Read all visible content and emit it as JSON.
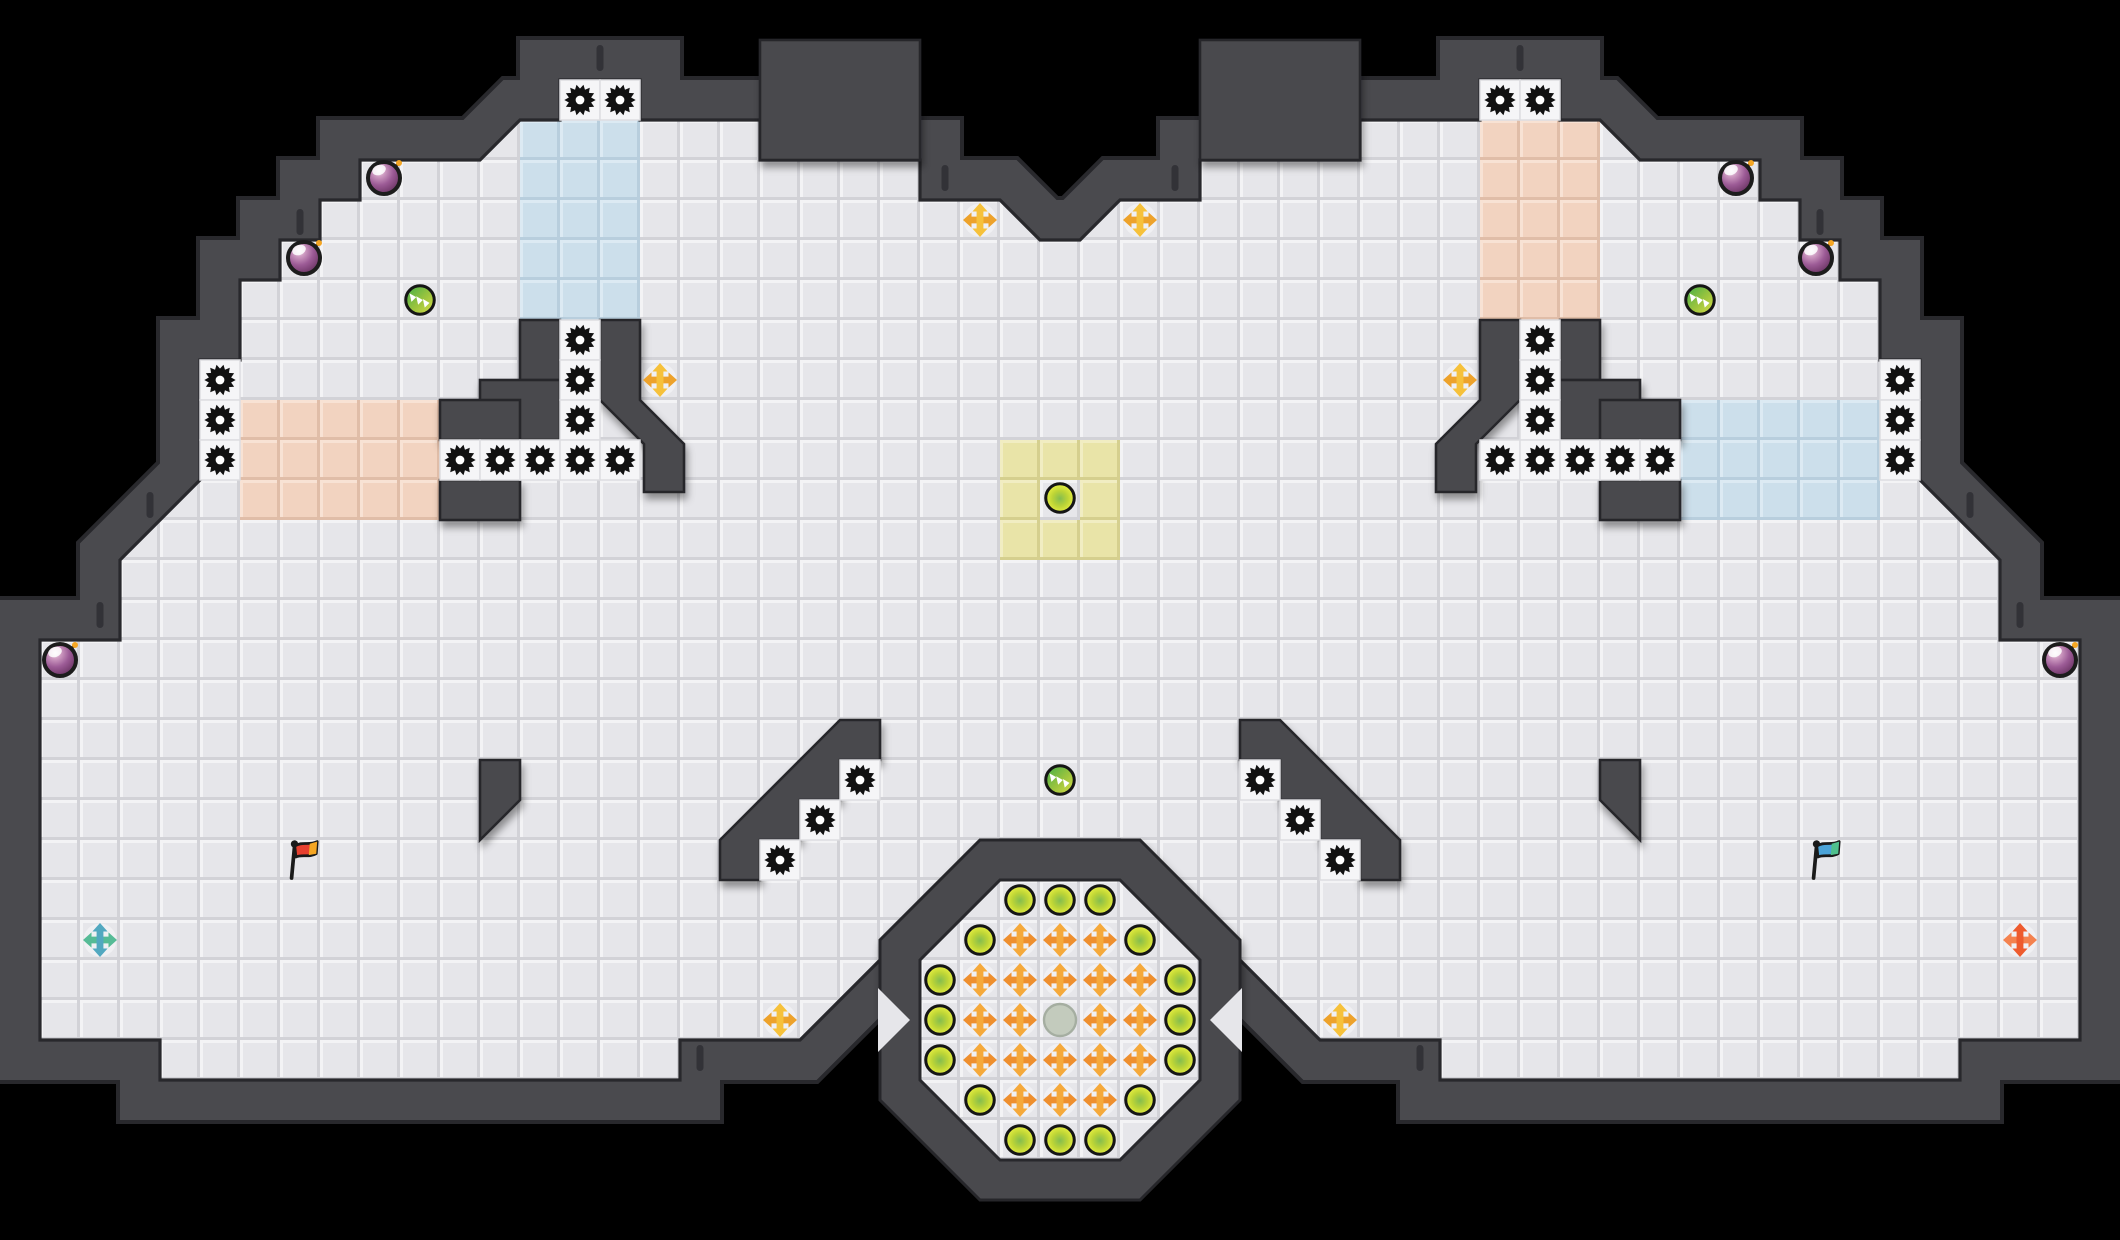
{
  "scene": {
    "width": 2120,
    "height": 1240,
    "background": "#000000",
    "tile_size": 40
  },
  "palette": {
    "floor": "#e6e6ea",
    "floor_hi": "#f3f3f5",
    "floor_lo": "#d2d2d7",
    "wall": "#4a4a4e",
    "wall_edge": "#28282c",
    "gear_cell": "#f5f5f7",
    "team_blue": "#ccdfeb",
    "team_pink": "#f2d3c0",
    "team_yellow": "#e9e4a8",
    "gear": "#111111",
    "bomb_outline": "#1c1c1c",
    "boost_gold_v": "#f6c13b",
    "boost_gold_h": "#eda22b",
    "boost_orange_v": "#f5a93b",
    "boost_orange_h": "#ee8f2e",
    "boost_teal_v": "#52a8c0",
    "boost_teal_h": "#56bb96",
    "boost_red_v": "#ee5b2e",
    "boost_red_h": "#f4824f",
    "flag_red": "#e8402f",
    "flag_red_tip": "#f5a623",
    "flag_blue": "#4ba3d8",
    "flag_blue_tip": "#4fc08d",
    "gray_pad": "#c3cbbd",
    "gray_pad_edge": "#a5aea1"
  },
  "map": {
    "floor_outline": [
      [
        560,
        80
      ],
      [
        640,
        80
      ],
      [
        640,
        120
      ],
      [
        760,
        120
      ],
      [
        760,
        160
      ],
      [
        920,
        160
      ],
      [
        920,
        200
      ],
      [
        1000,
        200
      ],
      [
        1040,
        240
      ],
      [
        1080,
        240
      ],
      [
        1120,
        200
      ],
      [
        1200,
        200
      ],
      [
        1200,
        160
      ],
      [
        1360,
        160
      ],
      [
        1360,
        120
      ],
      [
        1480,
        120
      ],
      [
        1480,
        80
      ],
      [
        1560,
        80
      ],
      [
        1560,
        120
      ],
      [
        1600,
        120
      ],
      [
        1640,
        160
      ],
      [
        1760,
        160
      ],
      [
        1760,
        200
      ],
      [
        1800,
        200
      ],
      [
        1800,
        240
      ],
      [
        1840,
        240
      ],
      [
        1840,
        280
      ],
      [
        1880,
        280
      ],
      [
        1880,
        360
      ],
      [
        1920,
        360
      ],
      [
        1920,
        480
      ],
      [
        2000,
        560
      ],
      [
        2000,
        640
      ],
      [
        2080,
        640
      ],
      [
        2080,
        1040
      ],
      [
        1960,
        1040
      ],
      [
        1960,
        1080
      ],
      [
        1440,
        1080
      ],
      [
        1440,
        1040
      ],
      [
        1320,
        1040
      ],
      [
        1120,
        840
      ],
      [
        1000,
        840
      ],
      [
        800,
        1040
      ],
      [
        680,
        1040
      ],
      [
        680,
        1080
      ],
      [
        160,
        1080
      ],
      [
        160,
        1040
      ],
      [
        40,
        1040
      ],
      [
        40,
        640
      ],
      [
        120,
        640
      ],
      [
        120,
        560
      ],
      [
        200,
        480
      ],
      [
        200,
        360
      ],
      [
        240,
        360
      ],
      [
        240,
        280
      ],
      [
        280,
        280
      ],
      [
        280,
        240
      ],
      [
        320,
        240
      ],
      [
        320,
        200
      ],
      [
        360,
        200
      ],
      [
        360,
        160
      ],
      [
        480,
        160
      ],
      [
        520,
        120
      ],
      [
        560,
        120
      ]
    ],
    "wall_rects": [
      [
        760,
        40,
        160,
        120
      ],
      [
        1200,
        40,
        160,
        120
      ],
      [
        520,
        320,
        40,
        60
      ],
      [
        480,
        380,
        80,
        60
      ],
      [
        440,
        400,
        80,
        40
      ],
      [
        440,
        480,
        80,
        40
      ],
      [
        1560,
        320,
        40,
        60
      ],
      [
        1560,
        380,
        80,
        60
      ],
      [
        1600,
        400,
        80,
        40
      ],
      [
        1600,
        480,
        80,
        40
      ]
    ],
    "wall_polys": [
      [
        [
          600,
          320
        ],
        [
          640,
          320
        ],
        [
          640,
          400
        ],
        [
          684,
          444
        ],
        [
          684,
          492
        ],
        [
          644,
          492
        ],
        [
          644,
          444
        ],
        [
          600,
          400
        ]
      ],
      [
        [
          1520,
          320
        ],
        [
          1480,
          320
        ],
        [
          1480,
          400
        ],
        [
          1436,
          444
        ],
        [
          1436,
          492
        ],
        [
          1476,
          492
        ],
        [
          1476,
          444
        ],
        [
          1520,
          400
        ]
      ],
      [
        [
          840,
          720
        ],
        [
          880,
          720
        ],
        [
          880,
          760
        ],
        [
          840,
          760
        ],
        [
          840,
          800
        ],
        [
          800,
          800
        ],
        [
          800,
          840
        ],
        [
          760,
          840
        ],
        [
          760,
          880
        ],
        [
          720,
          880
        ],
        [
          720,
          840
        ]
      ],
      [
        [
          1280,
          720
        ],
        [
          1240,
          720
        ],
        [
          1240,
          760
        ],
        [
          1280,
          760
        ],
        [
          1280,
          800
        ],
        [
          1320,
          800
        ],
        [
          1320,
          840
        ],
        [
          1360,
          840
        ],
        [
          1360,
          880
        ],
        [
          1400,
          880
        ],
        [
          1400,
          840
        ]
      ],
      [
        [
          480,
          760
        ],
        [
          520,
          760
        ],
        [
          520,
          800
        ],
        [
          480,
          840
        ]
      ],
      [
        [
          1640,
          760
        ],
        [
          1600,
          760
        ],
        [
          1600,
          800
        ],
        [
          1640,
          840
        ]
      ]
    ],
    "octagon": {
      "outer": [
        [
          980,
          840
        ],
        [
          1140,
          840
        ],
        [
          1240,
          940
        ],
        [
          1240,
          1100
        ],
        [
          1140,
          1200
        ],
        [
          980,
          1200
        ],
        [
          880,
          1100
        ],
        [
          880,
          940
        ]
      ],
      "inner": [
        [
          1000,
          880
        ],
        [
          1120,
          880
        ],
        [
          1200,
          960
        ],
        [
          1200,
          1080
        ],
        [
          1120,
          1160
        ],
        [
          1000,
          1160
        ],
        [
          920,
          1080
        ],
        [
          920,
          960
        ]
      ],
      "notches": [
        [
          [
            878,
            988
          ],
          [
            910,
            1020
          ],
          [
            878,
            1052
          ]
        ],
        [
          [
            1242,
            988
          ],
          [
            1210,
            1020
          ],
          [
            1242,
            1052
          ]
        ]
      ]
    },
    "regions": [
      {
        "name": "blue-tiles-top-left",
        "color_key": "team_blue",
        "rect": [
          520,
          120,
          120,
          200
        ]
      },
      {
        "name": "pink-tiles-top-right",
        "color_key": "team_pink",
        "rect": [
          1480,
          120,
          120,
          200
        ]
      },
      {
        "name": "pink-tiles-left",
        "color_key": "team_pink",
        "rect": [
          240,
          400,
          200,
          120
        ]
      },
      {
        "name": "blue-tiles-right",
        "color_key": "team_blue",
        "rect": [
          1680,
          400,
          200,
          120
        ]
      },
      {
        "name": "yellow-tiles-center",
        "color_key": "team_yellow",
        "rect": [
          1000,
          440,
          120,
          120
        ]
      }
    ],
    "yellow_center_hole": [
      1040,
      480,
      40,
      40
    ],
    "wall_dashes": [
      [
        600,
        58
      ],
      [
        1520,
        58
      ],
      [
        945,
        178
      ],
      [
        1175,
        178
      ],
      [
        300,
        222
      ],
      [
        1820,
        222
      ],
      [
        150,
        505
      ],
      [
        1970,
        505
      ],
      [
        100,
        615
      ],
      [
        2020,
        615
      ],
      [
        700,
        1058
      ],
      [
        1420,
        1058
      ]
    ]
  },
  "entities": {
    "gears": [
      [
        580,
        100
      ],
      [
        620,
        100
      ],
      [
        1500,
        100
      ],
      [
        1540,
        100
      ],
      [
        580,
        340
      ],
      [
        580,
        380
      ],
      [
        580,
        420
      ],
      [
        1540,
        340
      ],
      [
        1540,
        380
      ],
      [
        1540,
        420
      ],
      [
        460,
        460
      ],
      [
        500,
        460
      ],
      [
        540,
        460
      ],
      [
        580,
        460
      ],
      [
        620,
        460
      ],
      [
        1500,
        460
      ],
      [
        1540,
        460
      ],
      [
        1580,
        460
      ],
      [
        1620,
        460
      ],
      [
        1660,
        460
      ],
      [
        220,
        380
      ],
      [
        220,
        420
      ],
      [
        220,
        460
      ],
      [
        1900,
        380
      ],
      [
        1900,
        420
      ],
      [
        1900,
        460
      ],
      [
        860,
        780
      ],
      [
        820,
        820
      ],
      [
        780,
        860
      ],
      [
        1260,
        780
      ],
      [
        1300,
        820
      ],
      [
        1340,
        860
      ]
    ],
    "bombs": [
      [
        384,
        178
      ],
      [
        304,
        258
      ],
      [
        60,
        660
      ],
      [
        1736,
        178
      ],
      [
        1816,
        258
      ],
      [
        2060,
        660
      ]
    ],
    "chevron_orbs": [
      [
        420,
        300
      ],
      [
        1700,
        300
      ],
      [
        1060,
        780
      ]
    ],
    "powerup_orbs": [
      [
        1060,
        498
      ],
      [
        1020,
        900
      ],
      [
        1060,
        900
      ],
      [
        1100,
        900
      ],
      [
        980,
        940
      ],
      [
        1140,
        940
      ],
      [
        940,
        980
      ],
      [
        1180,
        980
      ],
      [
        940,
        1020
      ],
      [
        1180,
        1020
      ],
      [
        940,
        1060
      ],
      [
        1180,
        1060
      ],
      [
        980,
        1100
      ],
      [
        1140,
        1100
      ],
      [
        1020,
        1140
      ],
      [
        1060,
        1140
      ],
      [
        1100,
        1140
      ]
    ],
    "boosts_gold": [
      [
        980,
        220
      ],
      [
        1140,
        220
      ],
      [
        660,
        380
      ],
      [
        1460,
        380
      ],
      [
        780,
        1020
      ],
      [
        1340,
        1020
      ]
    ],
    "boosts_orange": [
      [
        1020,
        940
      ],
      [
        1060,
        940
      ],
      [
        1100,
        940
      ],
      [
        980,
        980
      ],
      [
        1020,
        980
      ],
      [
        1060,
        980
      ],
      [
        1100,
        980
      ],
      [
        1140,
        980
      ],
      [
        980,
        1020
      ],
      [
        1020,
        1020
      ],
      [
        1100,
        1020
      ],
      [
        1140,
        1020
      ],
      [
        980,
        1060
      ],
      [
        1020,
        1060
      ],
      [
        1060,
        1060
      ],
      [
        1100,
        1060
      ],
      [
        1140,
        1060
      ],
      [
        1020,
        1100
      ],
      [
        1060,
        1100
      ],
      [
        1100,
        1100
      ]
    ],
    "boost_teal": [
      [
        100,
        940
      ]
    ],
    "boost_red": [
      [
        2020,
        940
      ]
    ],
    "gray_pad": [
      [
        1060,
        1020
      ]
    ],
    "flags": [
      {
        "team": "red",
        "x": 296,
        "y": 858
      },
      {
        "team": "blue",
        "x": 1818,
        "y": 858
      }
    ]
  }
}
